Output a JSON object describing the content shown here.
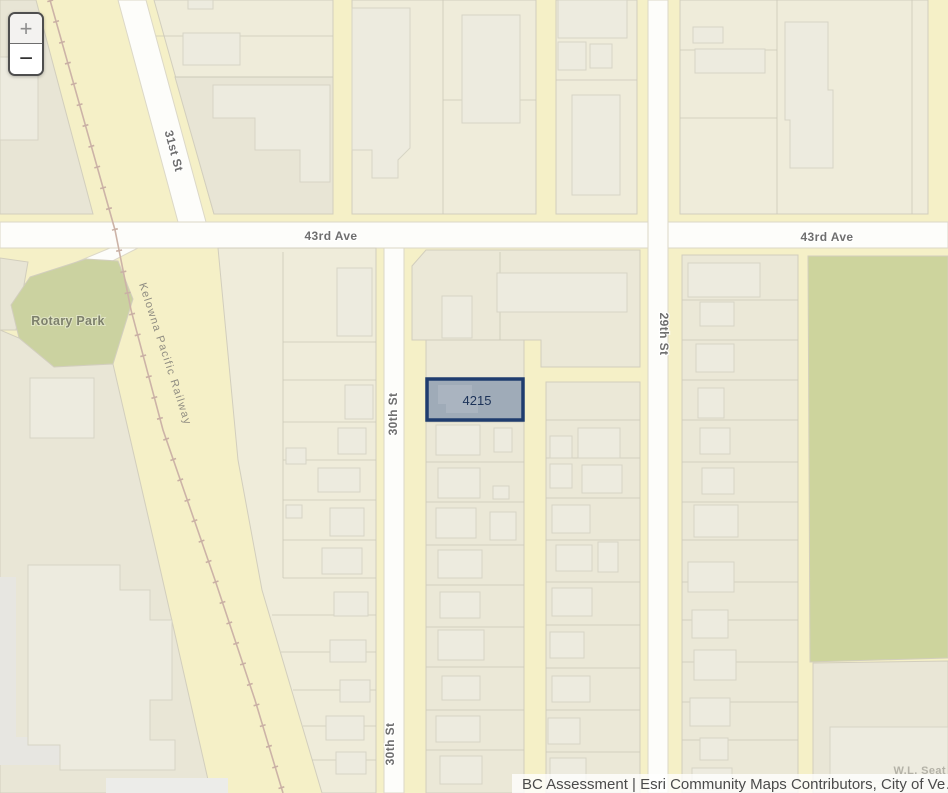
{
  "map": {
    "controls": {
      "zoom_in": "+",
      "zoom_out": "−"
    },
    "labels": {
      "street_31st": "31st St",
      "avenue_43rd_left": "43rd Ave",
      "avenue_43rd_right": "43rd Ave",
      "street_30th_upper": "30th St",
      "street_30th_lower": "30th St",
      "street_29th": "29th St",
      "park": "Rotary Park",
      "railway": "Kelowna Pacific Railway",
      "selected_parcel_id": "4215",
      "truncated_place": "W.L. Seat"
    },
    "attribution": "BC Assessment | Esri Community Maps Contributors, City of Ve…",
    "colors": {
      "road_yellow": "#f5f0c7",
      "street_white": "#fdfdfa",
      "block_cream": "#efecda",
      "block_gray": "#e8e5d5",
      "building": "#edebdf",
      "park_green": "#cbd2a0",
      "field_green": "#cdd49d",
      "railway_line": "#ccb3a7",
      "parcel_highlight_fill": "#9fabb8",
      "parcel_highlight_stroke": "#1f3c6e",
      "label_gray": "#6f6f6f"
    }
  }
}
